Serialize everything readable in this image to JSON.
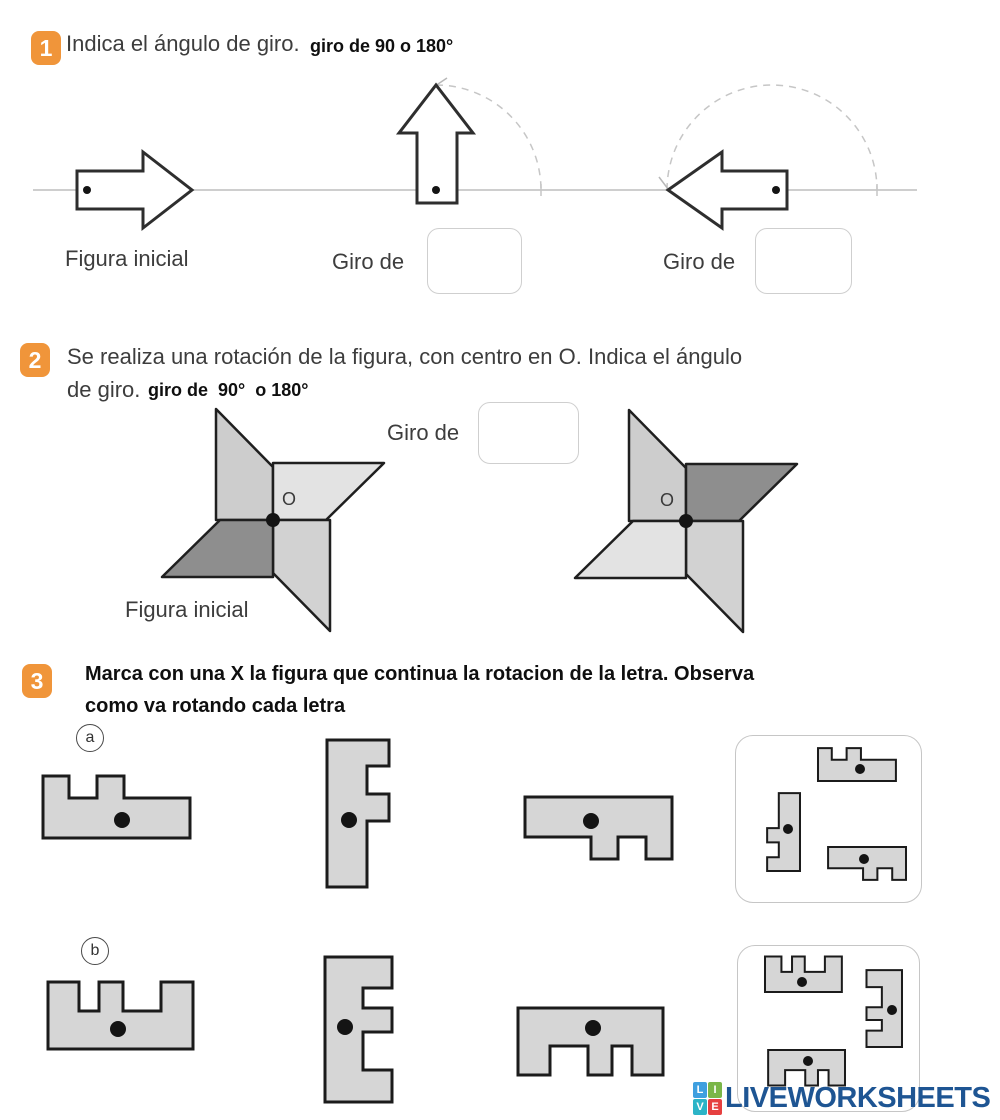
{
  "exercise1": {
    "number": "1",
    "title": "Indica el ángulo de giro.",
    "subtitle": "giro de 90 o 180°",
    "figure_label": "Figura inicial",
    "giro_label_1": "Giro de",
    "giro_label_2": "Giro de",
    "answer_1_value": "",
    "answer_2_value": ""
  },
  "exercise2": {
    "number": "2",
    "title_line1": "Se realiza una rotación de la figura, con centro en O. Indica el ángulo",
    "title_line2": "de giro.",
    "subtitle": "giro de  90°  o 180°",
    "giro_label": "Giro de",
    "answer_value": "",
    "figure_label": "Figura inicial",
    "center_label_1": "O",
    "center_label_2": "O",
    "pinwheel_initial": {
      "blade_colors": [
        "#cdcdcd",
        "#e3e3e3",
        "#d2d2d2",
        "#8e8e8e"
      ]
    },
    "pinwheel_rotated": {
      "blade_colors": [
        "#cdcdcd",
        "#8e8e8e",
        "#d2d2d2",
        "#e3e3e3"
      ]
    }
  },
  "exercise3": {
    "number": "3",
    "title_line1": "Marca con una X la figura que continua la rotacion de la letra. Observa",
    "title_line2": "como va rotando cada letra",
    "item_a_label": "a",
    "item_b_label": "b"
  },
  "logo": {
    "text": "LIVEWORKSHEETS",
    "squares": [
      {
        "letter": "L",
        "color": "#3f9fdf"
      },
      {
        "letter": "I",
        "color": "#7ab648"
      },
      {
        "letter": "V",
        "color": "#2cb4c7"
      },
      {
        "letter": "E",
        "color": "#e64040"
      }
    ]
  },
  "colors": {
    "badge_orange": "#f0953a",
    "shape_fill": "#d6d6d6",
    "shape_stroke": "#1b1b1b",
    "guide_line": "#bdbdbd",
    "logo_navy": "#1e5593"
  }
}
